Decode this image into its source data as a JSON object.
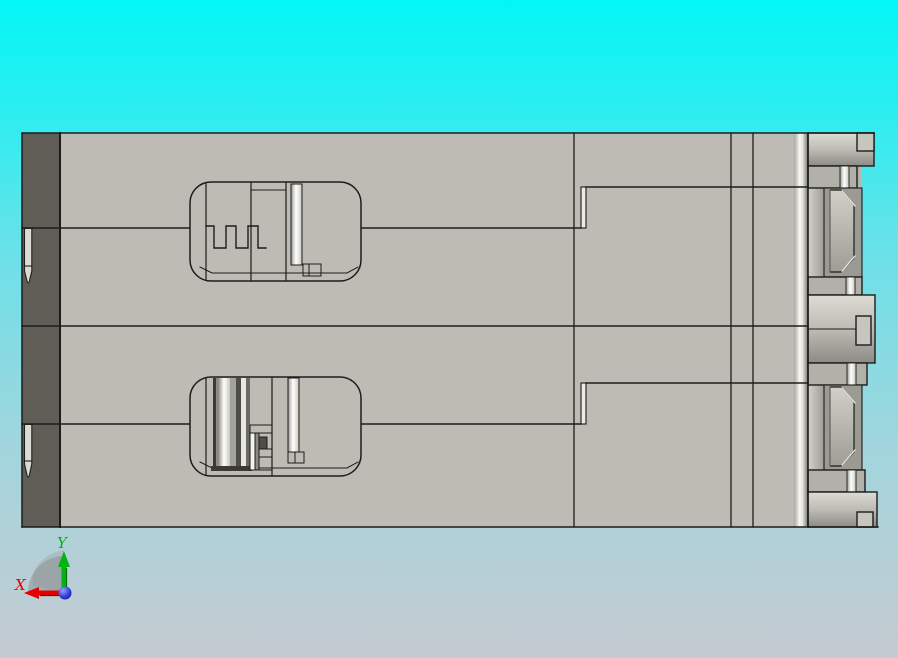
{
  "viewport": {
    "type": "cad-3d-view",
    "background_top_color": "#04f6f6",
    "background_bottom_color": "#c6cad1",
    "part": {
      "body_color": "#bdbbb3",
      "end_strip_color": "#5f5d56",
      "outline_color": "#1c1c1c",
      "white_detail_color": "#f4f3ee",
      "dark_detail_color": "#4e4d47",
      "cavity_count": "2",
      "pin_count": "2"
    },
    "axis_triad": {
      "x_label": "X",
      "y_label": "Y",
      "x_axis_color": "#e40000",
      "y_axis_color": "#00b412",
      "origin_color": "#2030c8",
      "plane_shadow_color": "#8c8c8c"
    }
  }
}
